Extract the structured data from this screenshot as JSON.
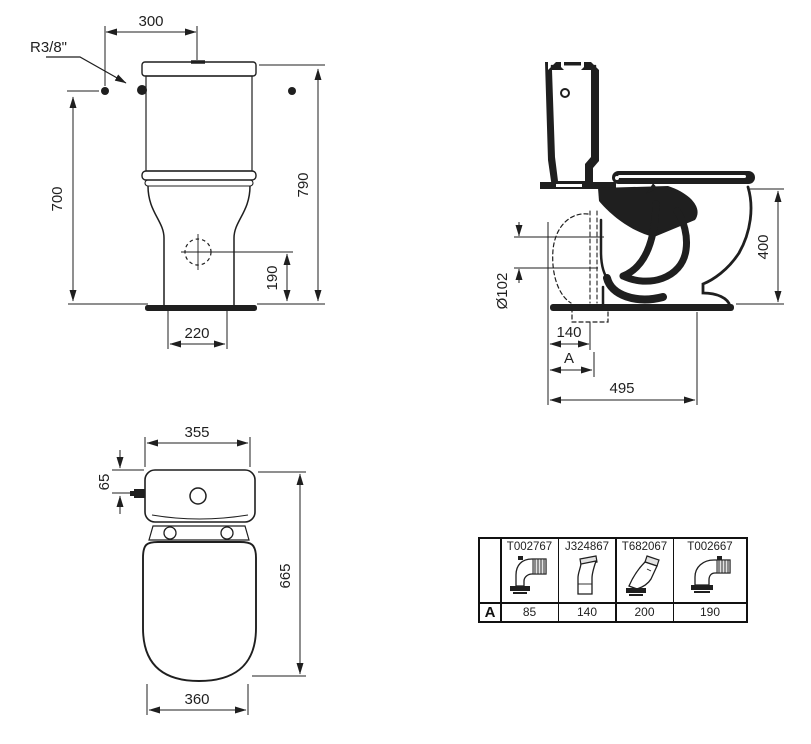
{
  "drawing": {
    "front_view": {
      "width_top": "300",
      "inlet_thread": "R3/8\"",
      "height_to_inlet": "700",
      "height_total": "790",
      "outlet_height": "190",
      "base_width": "220"
    },
    "side_view": {
      "seat_height": "400",
      "outlet_diameter": "Ø102",
      "outlet_distance": "140",
      "variable_label": "A",
      "depth_total": "495"
    },
    "top_view": {
      "cistern_width": "355",
      "inlet_offset": "65",
      "depth": "665",
      "bowl_width": "360"
    }
  },
  "accessories_table": {
    "row_label": "A",
    "columns": [
      {
        "code": "T002767",
        "value": "85",
        "icon": "elbow-corrugated-connector"
      },
      {
        "code": "J324867",
        "value": "140",
        "icon": "vertical-offset-connector"
      },
      {
        "code": "T682067",
        "value": "200",
        "icon": "angled-connector"
      },
      {
        "code": "T002667",
        "value": "190",
        "icon": "bend-corrugated-connector"
      }
    ]
  }
}
